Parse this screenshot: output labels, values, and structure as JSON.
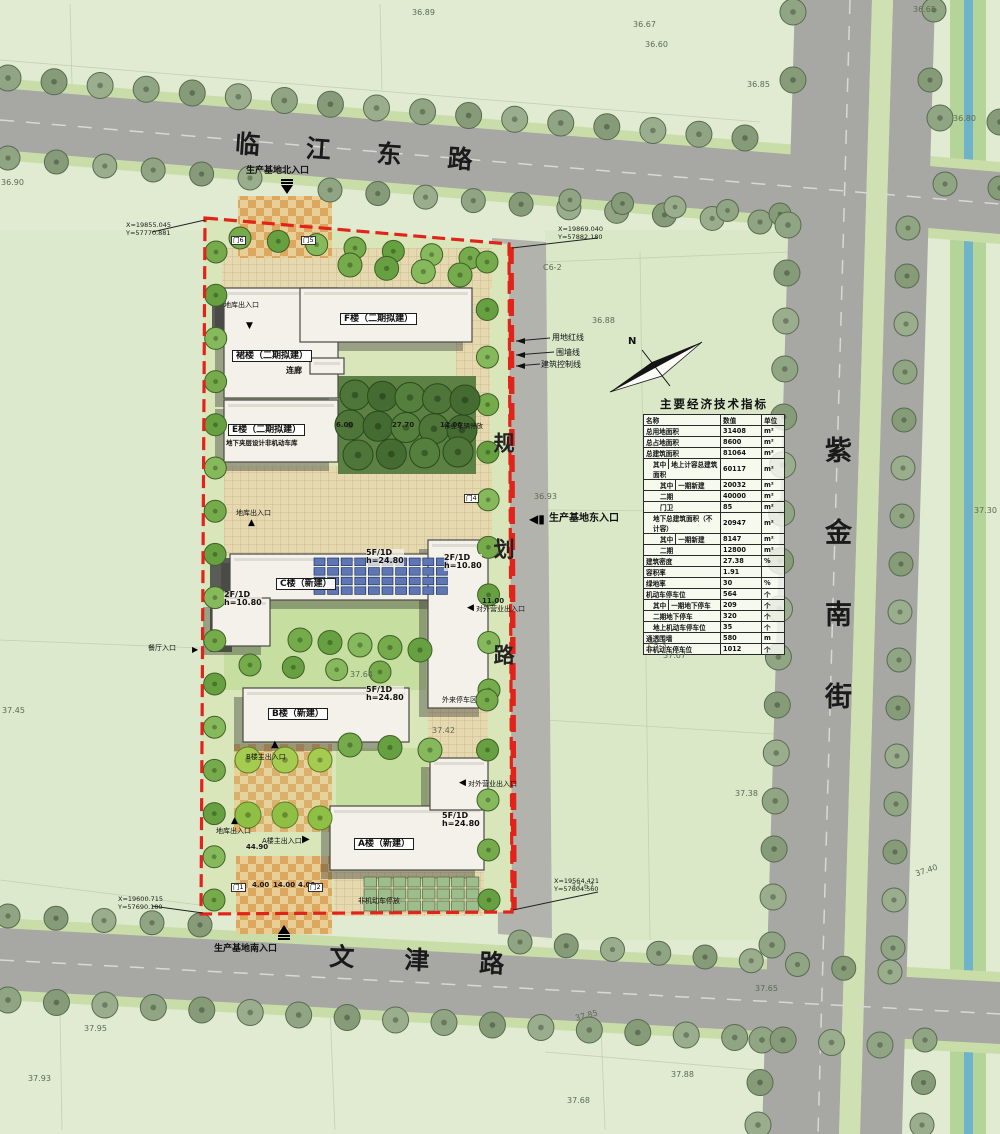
{
  "colors": {
    "boundary_red": "#e2231a",
    "road_gray": "#a7a7a3",
    "mid_road_gray": "#b3b3ae",
    "water_blue": "#6fb3c9",
    "site_green": "#d8e6ba",
    "building": "#f3f1e9",
    "pv_blue": "#5c76b8",
    "checker_orange": "#dca75f",
    "lawn": "#c6de9f"
  },
  "roads": {
    "north": "临江东路",
    "south": "文津路",
    "east": "紫金南街",
    "mid": "规划路"
  },
  "entrances": {
    "north": "生产基地北入口",
    "east": "生产基地东入口",
    "south": "生产基地南入口"
  },
  "coords": {
    "tl1": "X=19855.045",
    "tl2": "Y=57770.881",
    "tr1": "X=19869.040",
    "tr2": "Y=57882.180",
    "bl1": "X=19600.715",
    "bl2": "Y=57690.180",
    "br1": "X=19564.421",
    "br2": "Y=57804.560"
  },
  "lines": {
    "red": "用地红线",
    "wall": "围墙线",
    "control": "建筑控制线"
  },
  "buildings": {
    "f": "F楼（二期拟建）",
    "qun": "裙楼（二期拟建）",
    "lianlang": "连廊",
    "e": "E楼（二期拟建）",
    "e_sub": "地下夹层设计非机动车库",
    "c": "C楼（新建）",
    "b": "B楼（新建）",
    "a": "A楼（新建）"
  },
  "specs": {
    "c1": "5F/1D",
    "c2": "h=24.80",
    "b1": "5F/1D",
    "b2": "h=24.80",
    "a1": "5F/1D",
    "a2": "h=24.80",
    "d1": "2F/1D",
    "d2": "h=10.80",
    "w1": "2F/1D",
    "w2": "h=10.80"
  },
  "site_labels": {
    "canting": "餐厅入口",
    "diku1": "地库出入口",
    "diku2": "地库出入口",
    "diku3": "地库出入口",
    "a_main": "A楼主出入口",
    "b_main": "B楼主出入口",
    "duiwai1": "对外营业出入口",
    "duiwai2": "对外营业出入口",
    "wailai": "外来停车区",
    "zuoye": "作业车辆停放",
    "feijidong": "非机动车停放"
  },
  "gates": [
    {
      "t": "门6",
      "x": 231,
      "y": 236
    },
    {
      "t": "门5",
      "x": 301,
      "y": 236
    },
    {
      "t": "门4",
      "x": 464,
      "y": 494
    },
    {
      "t": "门1",
      "x": 231,
      "y": 883
    },
    {
      "t": "门2",
      "x": 308,
      "y": 883
    }
  ],
  "dims": [
    {
      "t": "6.00",
      "x": 336,
      "y": 421
    },
    {
      "t": "27.70",
      "x": 392,
      "y": 421
    },
    {
      "t": "12.00",
      "x": 440,
      "y": 421
    },
    {
      "t": "11.00",
      "x": 482,
      "y": 597
    },
    {
      "t": "44.90",
      "x": 246,
      "y": 843
    },
    {
      "t": "4.00",
      "x": 252,
      "y": 881
    },
    {
      "t": "14.00",
      "x": 273,
      "y": 881
    },
    {
      "t": "4.00",
      "x": 298,
      "y": 881
    }
  ],
  "elevations": [
    {
      "t": "36.89",
      "x": 412,
      "y": 8
    },
    {
      "t": "36.67",
      "x": 633,
      "y": 20
    },
    {
      "t": "36.60",
      "x": 645,
      "y": 40
    },
    {
      "t": "36.65",
      "x": 913,
      "y": 5
    },
    {
      "t": "36.85",
      "x": 747,
      "y": 80
    },
    {
      "t": "36.90",
      "x": 1,
      "y": 178
    },
    {
      "t": "36.80",
      "x": 953,
      "y": 114
    },
    {
      "t": "36.88",
      "x": 592,
      "y": 316
    },
    {
      "t": "36.93",
      "x": 534,
      "y": 492
    },
    {
      "t": "37.30",
      "x": 974,
      "y": 506
    },
    {
      "t": "C6-2",
      "x": 543,
      "y": 263
    },
    {
      "t": "C5-3",
      "x": 648,
      "y": 641
    },
    {
      "t": "37.67",
      "x": 663,
      "y": 651
    },
    {
      "t": "37.45",
      "x": 2,
      "y": 706
    },
    {
      "t": "37.64",
      "x": 350,
      "y": 670
    },
    {
      "t": "37.42",
      "x": 432,
      "y": 726
    },
    {
      "t": "37.38",
      "x": 735,
      "y": 789
    },
    {
      "t": "37.40",
      "x": 915,
      "y": 866,
      "r": -18
    },
    {
      "t": "37.67",
      "x": 571,
      "y": 882
    },
    {
      "t": "37.65",
      "x": 755,
      "y": 984
    },
    {
      "t": "37.85",
      "x": 575,
      "y": 1011,
      "r": -14
    },
    {
      "t": "37.95",
      "x": 84,
      "y": 1024
    },
    {
      "t": "37.93",
      "x": 28,
      "y": 1074
    },
    {
      "t": "37.88",
      "x": 671,
      "y": 1070
    },
    {
      "t": "37.68",
      "x": 567,
      "y": 1096
    }
  ],
  "compass": "N",
  "table": {
    "title": "主要经济技术指标",
    "header": {
      "name": "名称",
      "value": "数值",
      "unit": "单位"
    },
    "qizhong": "其中",
    "rows": [
      {
        "name": "总用地面积",
        "value": "31408",
        "unit": "m²"
      },
      {
        "name": "总占地面积",
        "value": "8600",
        "unit": "m²"
      },
      {
        "name": "总建筑面积",
        "value": "81064",
        "unit": "m²"
      },
      {
        "group": "其中",
        "name": "地上计容总建筑面积",
        "value": "60117",
        "unit": "m²",
        "indent": 1
      },
      {
        "group": "其中",
        "name": "一期新建",
        "value": "20032",
        "unit": "m²",
        "indent": 2
      },
      {
        "name": "二期",
        "value": "40000",
        "unit": "m²",
        "indent": 2
      },
      {
        "name": "门卫",
        "value": "85",
        "unit": "m²",
        "indent": 2
      },
      {
        "name": "地下总建筑面积（不计容）",
        "value": "20947",
        "unit": "m²",
        "indent": 1
      },
      {
        "group": "其中",
        "name": "一期新建",
        "value": "8147",
        "unit": "m²",
        "indent": 2
      },
      {
        "name": "二期",
        "value": "12800",
        "unit": "m²",
        "indent": 2
      },
      {
        "name": "建筑密度",
        "value": "27.38",
        "unit": "%"
      },
      {
        "name": "容积率",
        "value": "1.91",
        "unit": ""
      },
      {
        "name": "绿地率",
        "value": "30",
        "unit": "%"
      },
      {
        "name": "机动车停车位",
        "value": "564",
        "unit": "个"
      },
      {
        "group": "其中",
        "name": "一期地下停车",
        "value": "209",
        "unit": "个",
        "indent": 1
      },
      {
        "name": "二期地下停车",
        "value": "320",
        "unit": "个",
        "indent": 1
      },
      {
        "name": "地上机动车停车位",
        "value": "35",
        "unit": "个",
        "indent": 1
      },
      {
        "name": "通透围墙",
        "value": "580",
        "unit": "m"
      },
      {
        "name": "非机动车停车位",
        "value": "1012",
        "unit": "个"
      }
    ]
  }
}
